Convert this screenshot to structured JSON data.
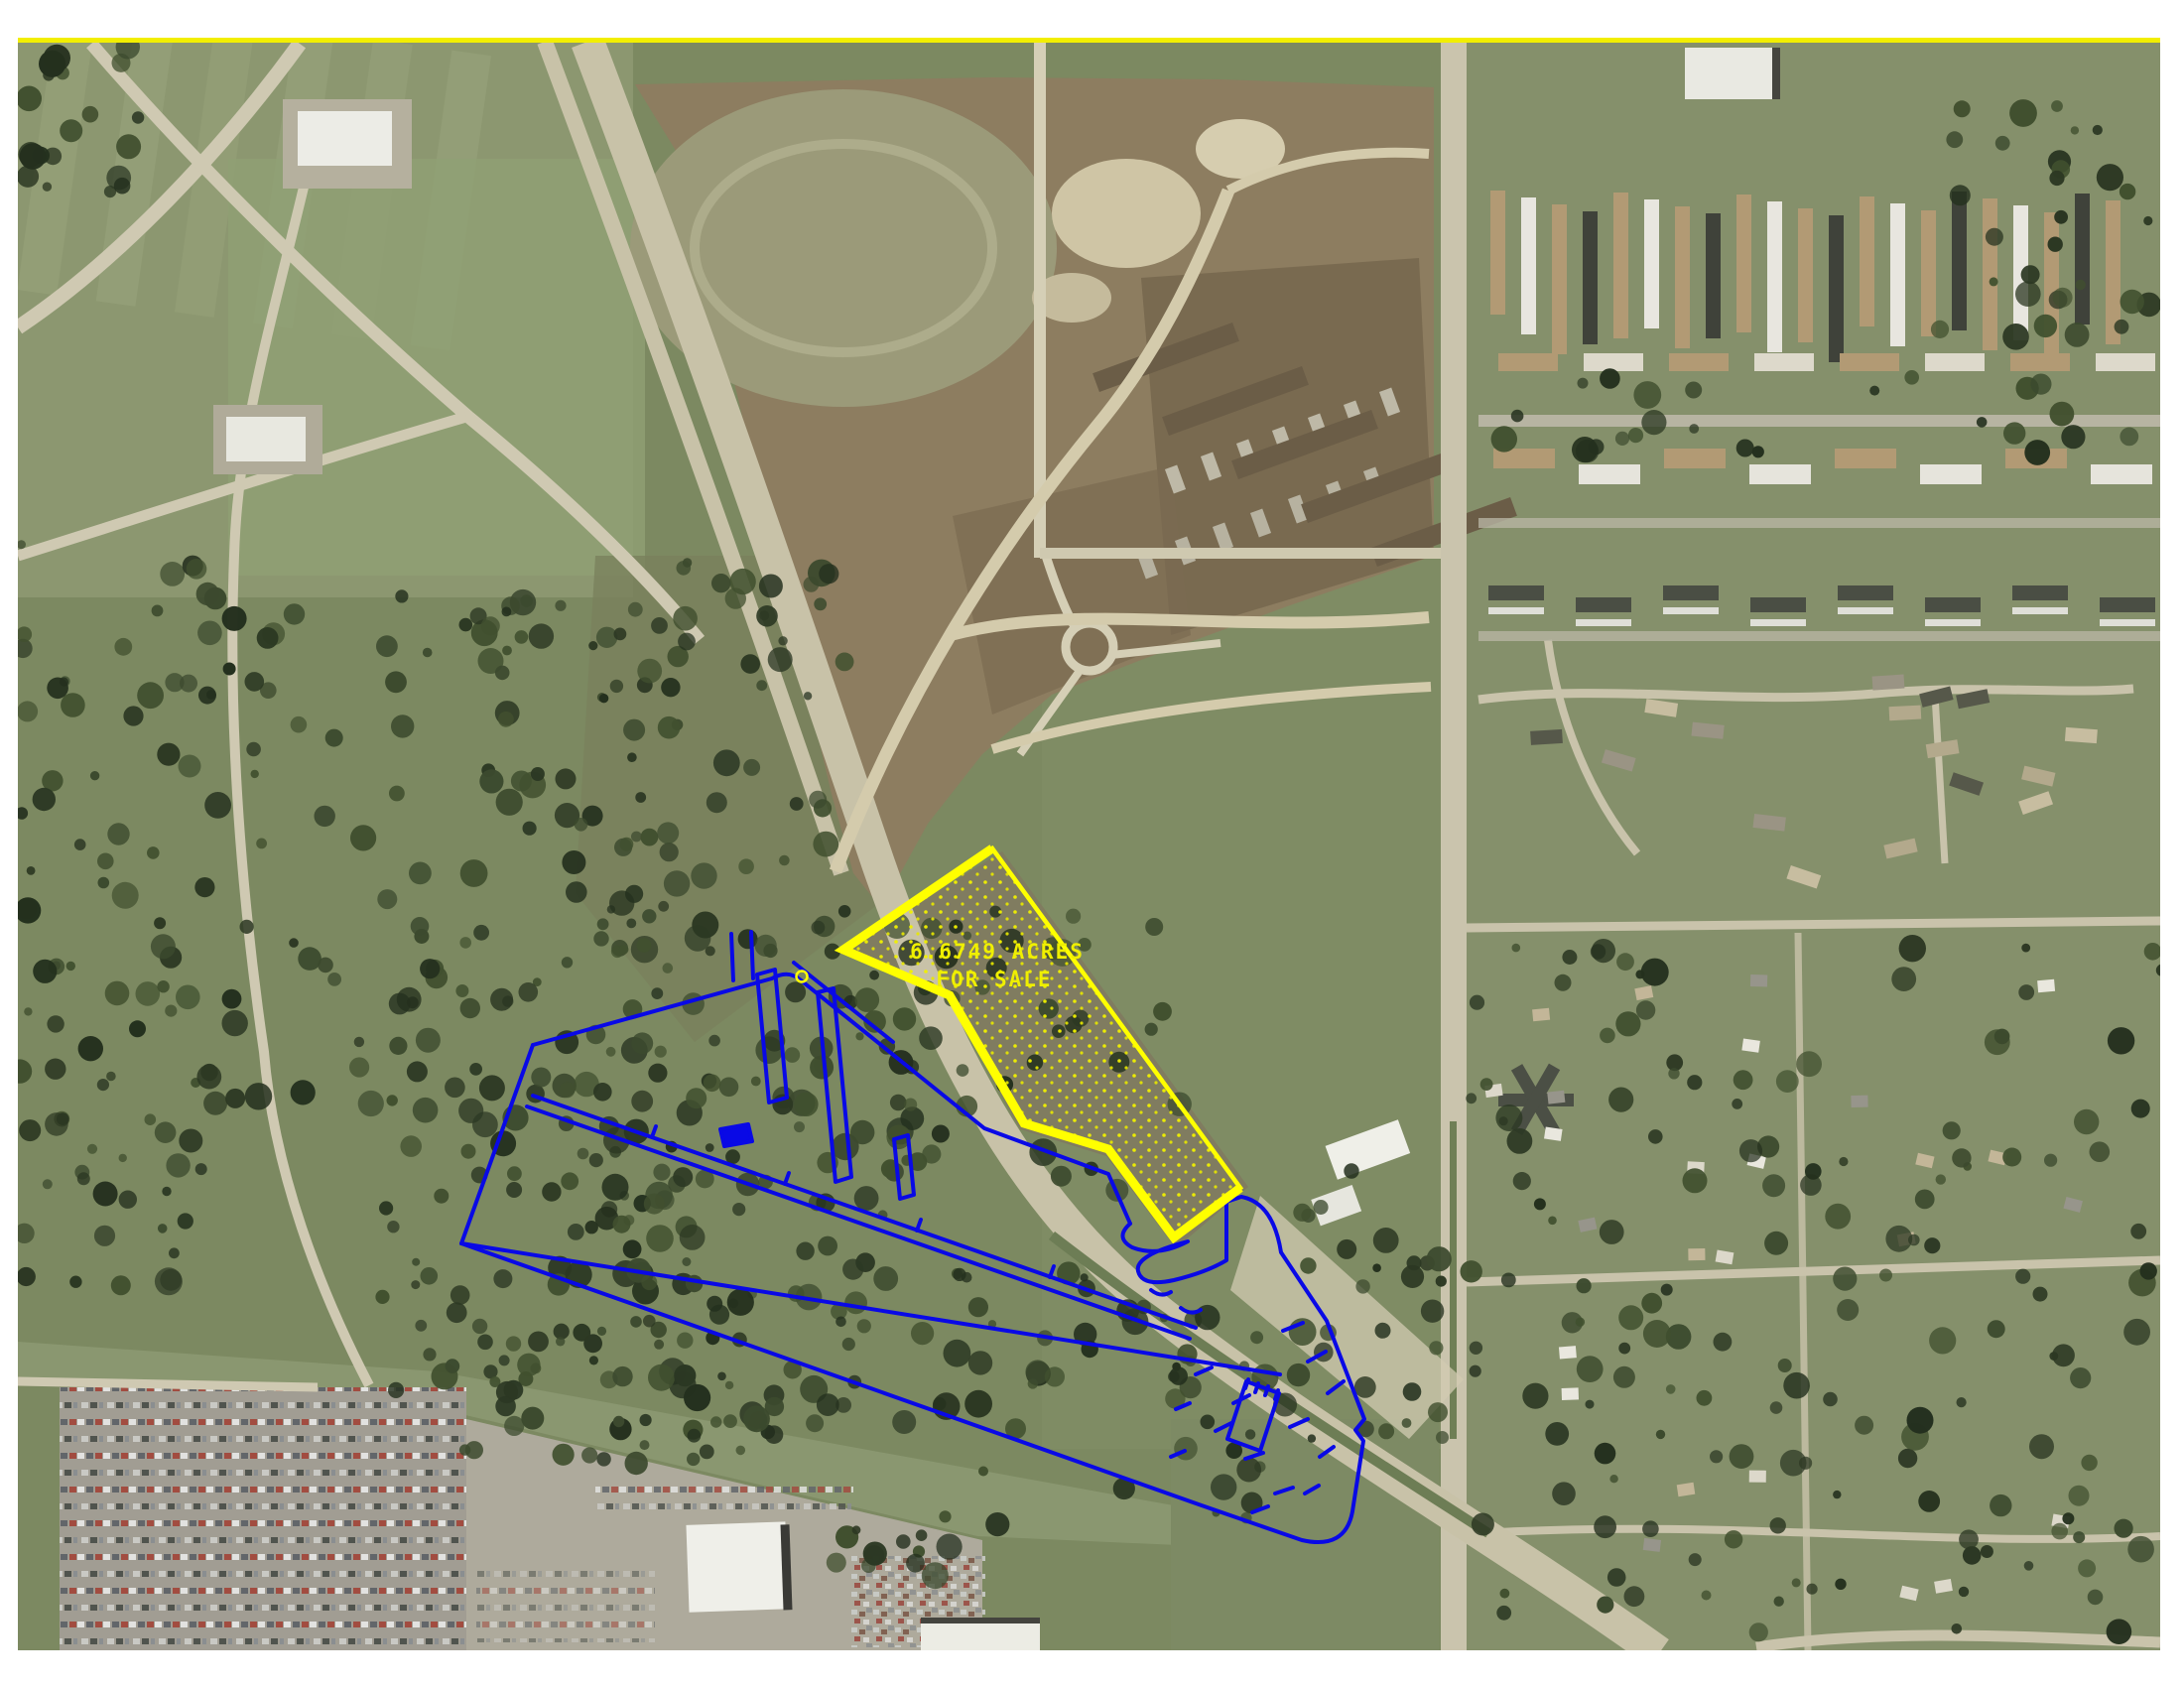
{
  "map": {
    "parcel": {
      "acreage_label": "6.6749 ACRES",
      "status_label": "FOR SALE",
      "outline_color": "#FFFF00",
      "dot_fill_color": "#F0F000",
      "label_color": "#EFEF00"
    },
    "site_outline": {
      "color": "#0909E6"
    },
    "border": {
      "color": "#F2EE00"
    }
  }
}
